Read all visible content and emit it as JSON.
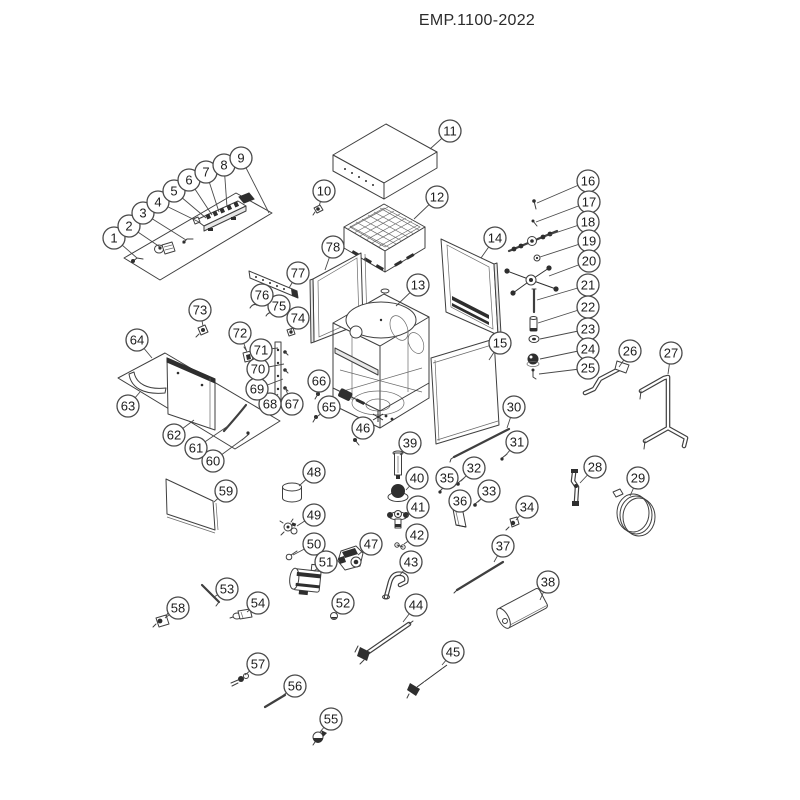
{
  "title": "EMP.1100-2022",
  "diagram": {
    "type": "exploded-parts-diagram",
    "line_color": "#3f3f3f",
    "balloon_radius": 11,
    "balloons": [
      {
        "n": "1",
        "x": 114,
        "y": 238,
        "tx": 137,
        "ty": 258
      },
      {
        "n": "2",
        "x": 129,
        "y": 226,
        "tx": 160,
        "ty": 247
      },
      {
        "n": "3",
        "x": 143,
        "y": 213,
        "tx": 186,
        "ty": 240
      },
      {
        "n": "4",
        "x": 158,
        "y": 202,
        "tx": 199,
        "ty": 222
      },
      {
        "n": "5",
        "x": 174,
        "y": 191,
        "tx": 206,
        "ty": 218
      },
      {
        "n": "6",
        "x": 189,
        "y": 180,
        "tx": 212,
        "ty": 215
      },
      {
        "n": "7",
        "x": 206,
        "y": 172,
        "tx": 219,
        "ty": 212
      },
      {
        "n": "8",
        "x": 224,
        "y": 165,
        "tx": 227,
        "ty": 207
      },
      {
        "n": "9",
        "x": 241,
        "y": 158,
        "tx": 269,
        "ty": 213
      },
      {
        "n": "10",
        "x": 324,
        "y": 191,
        "tx": 319,
        "ty": 206
      },
      {
        "n": "11",
        "x": 450,
        "y": 131,
        "tx": 430,
        "ty": 149
      },
      {
        "n": "12",
        "x": 437,
        "y": 197,
        "tx": 414,
        "ty": 219
      },
      {
        "n": "13",
        "x": 418,
        "y": 285,
        "tx": 396,
        "ty": 306
      },
      {
        "n": "14",
        "x": 495,
        "y": 238,
        "tx": 481,
        "ty": 258
      },
      {
        "n": "15",
        "x": 500,
        "y": 343,
        "tx": 489,
        "ty": 360
      },
      {
        "n": "16",
        "x": 588,
        "y": 181,
        "tx": 537,
        "ty": 203
      },
      {
        "n": "17",
        "x": 589,
        "y": 202,
        "tx": 536,
        "ty": 222
      },
      {
        "n": "18",
        "x": 588,
        "y": 222,
        "tx": 546,
        "ty": 236
      },
      {
        "n": "19",
        "x": 589,
        "y": 241,
        "tx": 540,
        "ty": 257
      },
      {
        "n": "20",
        "x": 589,
        "y": 261,
        "tx": 549,
        "ty": 276
      },
      {
        "n": "21",
        "x": 588,
        "y": 285,
        "tx": 537,
        "ty": 300
      },
      {
        "n": "22",
        "x": 588,
        "y": 307,
        "tx": 538,
        "ty": 323
      },
      {
        "n": "23",
        "x": 588,
        "y": 329,
        "tx": 540,
        "ty": 339
      },
      {
        "n": "24",
        "x": 588,
        "y": 349,
        "tx": 540,
        "ty": 359
      },
      {
        "n": "25",
        "x": 588,
        "y": 368,
        "tx": 539,
        "ty": 374
      },
      {
        "n": "26",
        "x": 630,
        "y": 351,
        "tx": 619,
        "ty": 367
      },
      {
        "n": "27",
        "x": 671,
        "y": 353,
        "tx": 668,
        "ty": 374
      },
      {
        "n": "28",
        "x": 595,
        "y": 467,
        "tx": 580,
        "ty": 483
      },
      {
        "n": "29",
        "x": 638,
        "y": 478,
        "tx": 630,
        "ty": 496
      },
      {
        "n": "30",
        "x": 514,
        "y": 407,
        "tx": 507,
        "ty": 428
      },
      {
        "n": "31",
        "x": 517,
        "y": 442,
        "tx": 505,
        "ty": 456
      },
      {
        "n": "32",
        "x": 474,
        "y": 468,
        "tx": 461,
        "ty": 481
      },
      {
        "n": "33",
        "x": 489,
        "y": 491,
        "tx": 478,
        "ty": 502
      },
      {
        "n": "34",
        "x": 527,
        "y": 507,
        "tx": 516,
        "ty": 520
      },
      {
        "n": "35",
        "x": 447,
        "y": 478,
        "tx": 442,
        "ty": 489
      },
      {
        "n": "36",
        "x": 460,
        "y": 501,
        "tx": 459,
        "ty": 511
      },
      {
        "n": "37",
        "x": 503,
        "y": 546,
        "tx": 494,
        "ty": 562
      },
      {
        "n": "38",
        "x": 548,
        "y": 582,
        "tx": 540,
        "ty": 600
      },
      {
        "n": "39",
        "x": 410,
        "y": 443,
        "tx": 400,
        "ty": 455
      },
      {
        "n": "40",
        "x": 417,
        "y": 478,
        "tx": 406,
        "ty": 490
      },
      {
        "n": "41",
        "x": 418,
        "y": 507,
        "tx": 407,
        "ty": 516
      },
      {
        "n": "42",
        "x": 417,
        "y": 535,
        "tx": 404,
        "ty": 544
      },
      {
        "n": "43",
        "x": 411,
        "y": 562,
        "tx": 399,
        "ty": 576
      },
      {
        "n": "44",
        "x": 416,
        "y": 605,
        "tx": 403,
        "ty": 622
      },
      {
        "n": "45",
        "x": 453,
        "y": 652,
        "tx": 442,
        "ty": 665
      },
      {
        "n": "46",
        "x": 363,
        "y": 428,
        "tx": 357,
        "ty": 438
      },
      {
        "n": "47",
        "x": 371,
        "y": 544,
        "tx": 358,
        "ty": 555
      },
      {
        "n": "48",
        "x": 314,
        "y": 472,
        "tx": 299,
        "ty": 486
      },
      {
        "n": "49",
        "x": 314,
        "y": 515,
        "tx": 297,
        "ty": 526
      },
      {
        "n": "50",
        "x": 314,
        "y": 544,
        "tx": 293,
        "ty": 555
      },
      {
        "n": "51",
        "x": 326,
        "y": 562,
        "tx": 314,
        "ty": 571
      },
      {
        "n": "52",
        "x": 343,
        "y": 603,
        "tx": 336,
        "ty": 614
      },
      {
        "n": "53",
        "x": 227,
        "y": 589,
        "tx": 214,
        "ty": 597
      },
      {
        "n": "54",
        "x": 258,
        "y": 603,
        "tx": 247,
        "ty": 612
      },
      {
        "n": "55",
        "x": 331,
        "y": 719,
        "tx": 320,
        "ty": 732
      },
      {
        "n": "56",
        "x": 295,
        "y": 686,
        "tx": 281,
        "ty": 697
      },
      {
        "n": "57",
        "x": 258,
        "y": 664,
        "tx": 245,
        "ty": 675
      },
      {
        "n": "58",
        "x": 178,
        "y": 608,
        "tx": 165,
        "ty": 618
      },
      {
        "n": "59",
        "x": 226,
        "y": 491,
        "tx": 214,
        "ty": 502
      },
      {
        "n": "60",
        "x": 213,
        "y": 461,
        "tx": 243,
        "ty": 439
      },
      {
        "n": "61",
        "x": 196,
        "y": 448,
        "tx": 228,
        "ty": 426
      },
      {
        "n": "62",
        "x": 174,
        "y": 435,
        "tx": 194,
        "ty": 420
      },
      {
        "n": "63",
        "x": 128,
        "y": 406,
        "tx": 140,
        "ty": 392
      },
      {
        "n": "64",
        "x": 137,
        "y": 340,
        "tx": 152,
        "ty": 358
      },
      {
        "n": "65",
        "x": 329,
        "y": 407,
        "tx": 318,
        "ty": 416
      },
      {
        "n": "66",
        "x": 319,
        "y": 381,
        "tx": 317,
        "ty": 393
      },
      {
        "n": "67",
        "x": 292,
        "y": 404,
        "tx": 286,
        "ty": 390
      },
      {
        "n": "68",
        "x": 270,
        "y": 404,
        "tx": 278,
        "ty": 394
      },
      {
        "n": "69",
        "x": 257,
        "y": 389,
        "tx": 283,
        "ty": 379
      },
      {
        "n": "70",
        "x": 258,
        "y": 369,
        "tx": 284,
        "ty": 364
      },
      {
        "n": "71",
        "x": 261,
        "y": 350,
        "tx": 278,
        "ty": 348
      },
      {
        "n": "72",
        "x": 240,
        "y": 333,
        "tx": 247,
        "ty": 352
      },
      {
        "n": "73",
        "x": 200,
        "y": 310,
        "tx": 203,
        "ty": 326
      },
      {
        "n": "74",
        "x": 298,
        "y": 318,
        "tx": 291,
        "ty": 330
      },
      {
        "n": "75",
        "x": 279,
        "y": 306,
        "tx": 271,
        "ty": 313
      },
      {
        "n": "76",
        "x": 262,
        "y": 295,
        "tx": 255,
        "ty": 304
      },
      {
        "n": "77",
        "x": 298,
        "y": 273,
        "tx": 289,
        "ty": 288
      },
      {
        "n": "78",
        "x": 333,
        "y": 247,
        "tx": 325,
        "ty": 270
      }
    ]
  }
}
